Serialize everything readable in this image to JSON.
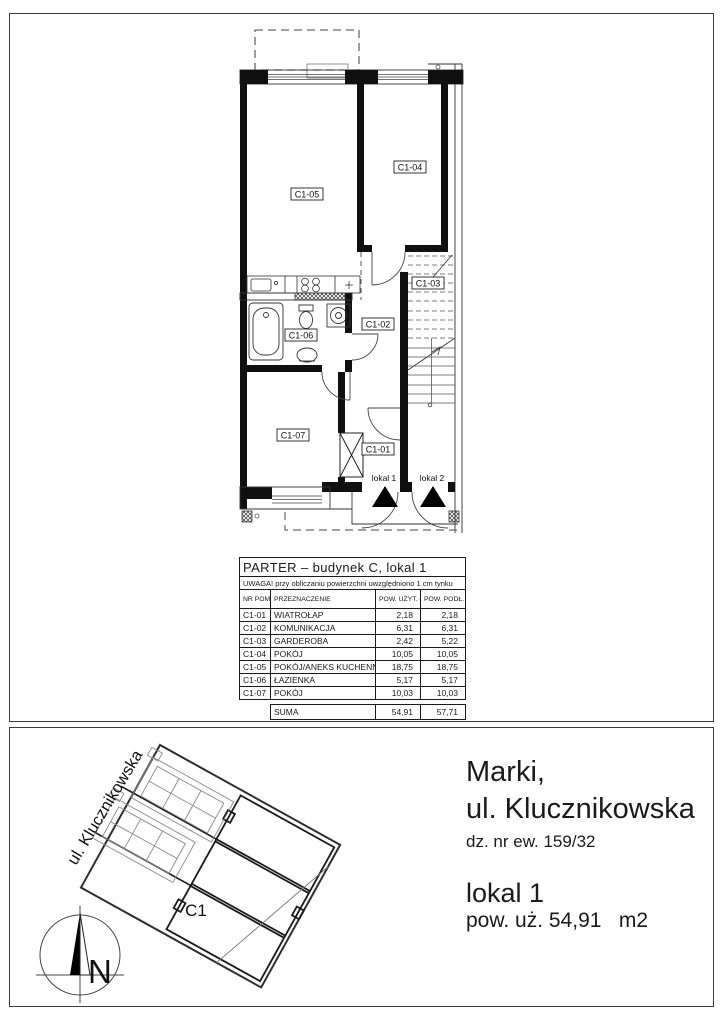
{
  "table": {
    "title": "PARTER – budynek C, lokal 1",
    "note": "UWAGA! przy obliczaniu powierzchni uwzględniono 1 cm tynku",
    "headers": {
      "nr": "NR POM.",
      "name": "PRZEZNACZENIE",
      "uzyt": "POW. UŻYT. (m²)",
      "podl": "POW. PODŁ. (m²)"
    },
    "rows": [
      {
        "nr": "C1-01",
        "name": "WIATROŁAP",
        "uzyt": "2,18",
        "podl": "2,18"
      },
      {
        "nr": "C1-02",
        "name": "KOMUNIKACJA",
        "uzyt": "6,31",
        "podl": "6,31"
      },
      {
        "nr": "C1-03",
        "name": "GARDEROBA",
        "uzyt": "2,42",
        "podl": "5,22"
      },
      {
        "nr": "C1-04",
        "name": "POKÓJ",
        "uzyt": "10,05",
        "podl": "10,05"
      },
      {
        "nr": "C1-05",
        "name": "POKÓJ/ANEKS KUCHENNY",
        "uzyt": "18,75",
        "podl": "18,75"
      },
      {
        "nr": "C1-06",
        "name": "ŁAZIENKA",
        "uzyt": "5,17",
        "podl": "5,17"
      },
      {
        "nr": "C1-07",
        "name": "POKÓJ",
        "uzyt": "10,03",
        "podl": "10,03"
      }
    ],
    "sum": {
      "label": "SUMA",
      "uzyt": "54,91",
      "podl": "57,71"
    }
  },
  "floor_plan": {
    "labels": {
      "c101": "C1-01",
      "c102": "C1-02",
      "c103": "C1-03",
      "c104": "C1-04",
      "c105": "C1-05",
      "c106": "C1-06",
      "c107": "C1-07",
      "lokal1": "lokal 1",
      "lokal2": "lokal 2"
    }
  },
  "site_plan": {
    "street": "ul. Klucznikowska",
    "building": "C1",
    "north": "N"
  },
  "address": {
    "city": "Marki,",
    "street": "ul. Klucznikowska",
    "plot": "dz. nr ew. 159/32",
    "unit": "lokal 1",
    "area": "pow. uż. 54,91   m2"
  }
}
